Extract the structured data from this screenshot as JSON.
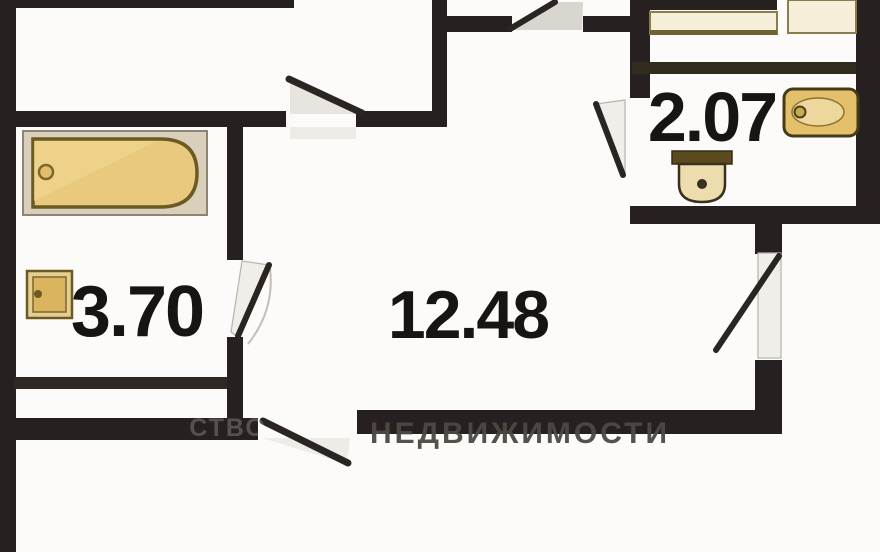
{
  "plan": {
    "type": "apartment-floor-plan",
    "rooms": {
      "bathroom": {
        "area": "3.70"
      },
      "hall": {
        "area": "12.48"
      },
      "wc": {
        "area": "2.07"
      }
    },
    "watermark": {
      "main": "НЕДВИЖИМОСТИ",
      "prefix": "СТВО"
    },
    "fixtures": [
      "bathtub-icon",
      "washbasin-small-icon",
      "washbasin-icon",
      "toilet-icon",
      "kitchen-counter-icon",
      "kitchen-counter-icon"
    ],
    "colors": {
      "wall": "#262120",
      "background": "#fcfbf9",
      "fixture_fill": "#e9c97e",
      "fixture_border": "#6b5a22",
      "counter_fill": "#f5eed8",
      "label_text": "#171513",
      "watermark_text": "#4d4842"
    }
  }
}
